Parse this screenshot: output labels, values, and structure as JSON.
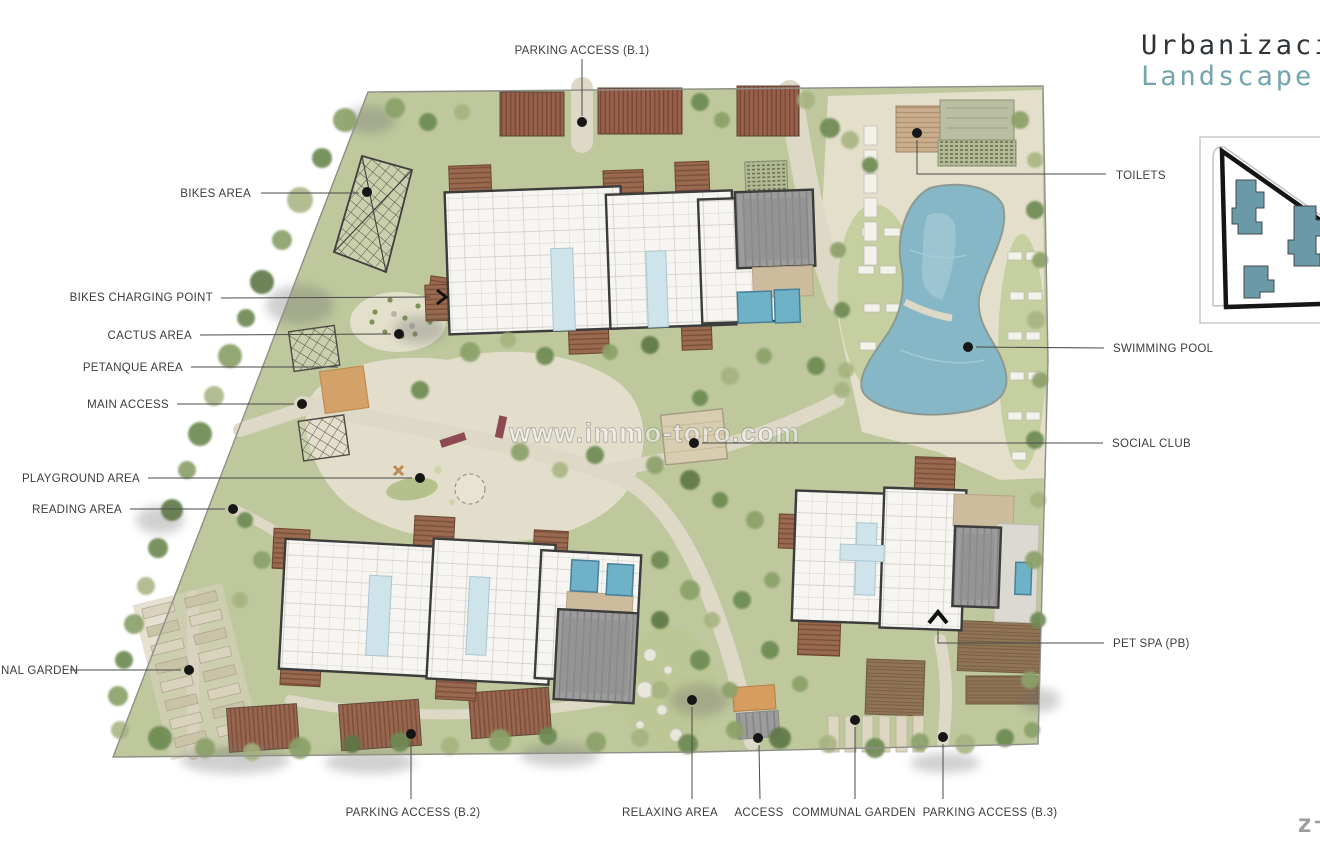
{
  "header": {
    "title_line1": "Urbanizaci",
    "title_line2": "Landscape"
  },
  "watermark": "www.immo-toro.com",
  "labels": {
    "parking_b1": "PARKING ACCESS (B.1)",
    "bikes_area": "BIKES AREA",
    "bikes_charging_point": "BIKES CHARGING POINT",
    "cactus_area": "CACTUS AREA",
    "petanque_area": "PETANQUE AREA",
    "main_access": "MAIN ACCESS",
    "playground_area": "PLAYGROUND AREA",
    "reading_area": "READING AREA",
    "communal_garden_left": "NAL GARDEN",
    "toilets": "TOILETS",
    "swimming_pool": "SWIMMING POOL",
    "social_club": "SOCIAL CLUB",
    "pet_spa": "PET SPA (PB)",
    "parking_b2": "PARKING ACCESS (B.2)",
    "relaxing_area": "RELAXING AREA",
    "access": "ACCESS",
    "communal_garden": "COMMUNAL GARDEN",
    "parking_b3": "PARKING ACCESS (B.3)"
  },
  "logo": {
    "letter": "z"
  },
  "colors": {
    "title_dark": "#2e3438",
    "landscape_teal": "#74a4ae",
    "grass": "#bec89c",
    "path": "#e4dfcb",
    "pool": "#85b7c6",
    "keymap_building": "#6a99a7"
  }
}
